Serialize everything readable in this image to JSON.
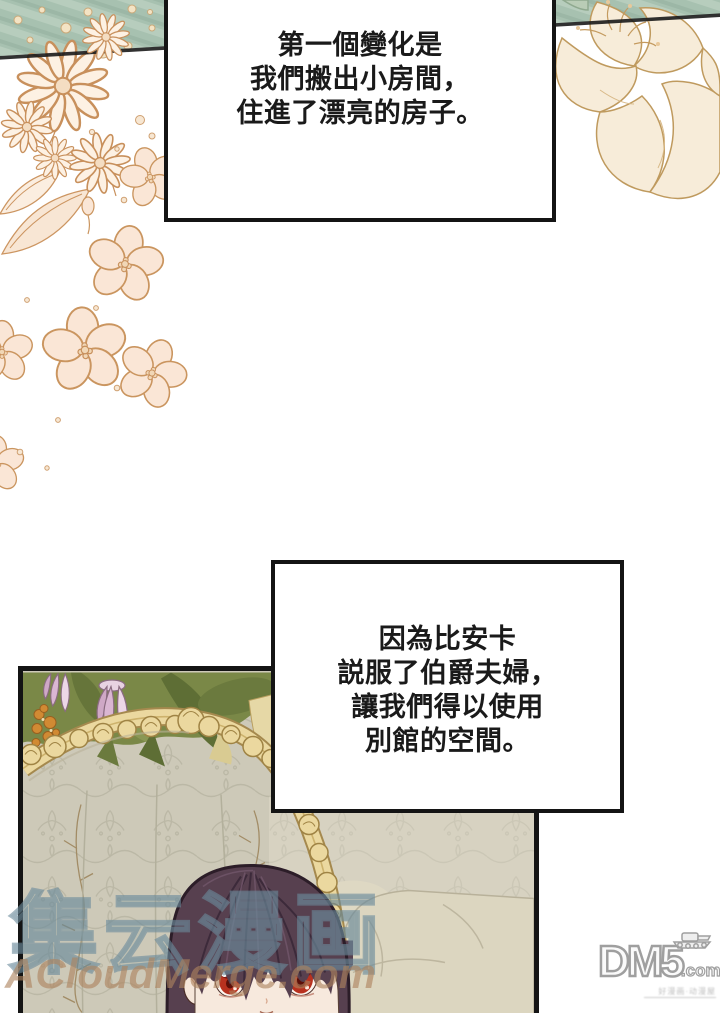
{
  "narration_boxes": [
    {
      "lines": [
        "第一個變化是",
        "我們搬出小房間，",
        "住進了漂亮的房子。"
      ]
    },
    {
      "lines": [
        "因為比安卡",
        "説服了伯爵夫婦，",
        "讓我們得以使用",
        "別館的空間。"
      ]
    }
  ],
  "watermarks": {
    "site_cn": "集云漫画",
    "site_en": "ACloudMerge.com"
  },
  "dm5": {
    "wordmark": "DM5",
    "domain_suffix": ".com",
    "caption": "好漫画·动漫屋"
  },
  "colors": {
    "panel_border": "#141414",
    "green_strip": "#a7c1b0",
    "floral_outline": "#cc9561",
    "floral_fill": "#fae6d6",
    "foliage_green": "#7a8847",
    "gold_frame": "#ebd89f",
    "wallpaper": "#cdc9b8",
    "hair": "#57404f",
    "eye_red": "#b8311f",
    "watermark_blue": "#6a8a9b",
    "watermark_tan": "#ad825e"
  }
}
